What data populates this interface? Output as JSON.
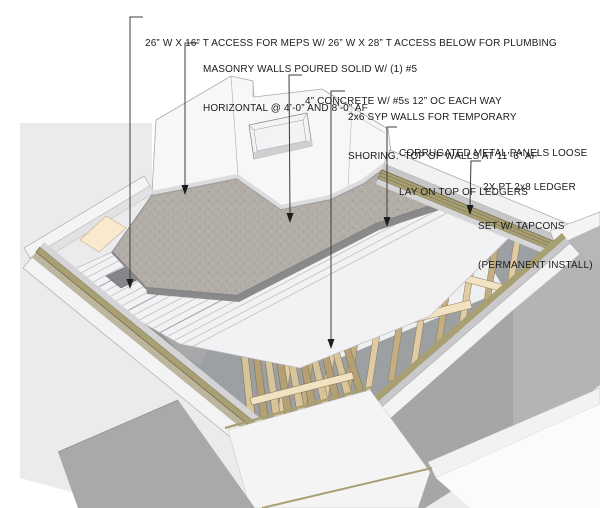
{
  "drawing": {
    "type": "construction-detail-axonometric",
    "subject": "Temporary shoring and new concrete deck over wall opening"
  },
  "annotations": [
    {
      "id": "access",
      "lines": [
        "26” W X 16” T ACCESS FOR MEPS W/ 26” W X 28” T ACCESS BELOW FOR PLUMBING"
      ]
    },
    {
      "id": "masonry",
      "lines": [
        "MASONRY WALLS POURED SOLID W/ (1) #5",
        "HORIZONTAL @ 4’-0” AND 8’-0” AF"
      ]
    },
    {
      "id": "concrete",
      "lines": [
        "4” CONCRETE W/ #5s 12” OC EACH WAY"
      ]
    },
    {
      "id": "shoring",
      "lines": [
        "2x6 SYP WALLS FOR TEMPORARY",
        "SHORING.  TOP OF WALLS AT 11’-6” AF"
      ]
    },
    {
      "id": "panels",
      "lines": [
        "CORRUGATED METAL PANELS LOOSE",
        "LAY ON TOP OF LEDGERS"
      ]
    },
    {
      "id": "ledger",
      "lines": [
        "2X PT 2x8 LEDGER",
        "SET W/ TAPCONS",
        "(PERMANENT INSTALL)"
      ]
    }
  ],
  "materials": {
    "backdrop": "#ebebed",
    "concrete_slab": "#b2ada6",
    "slab_edge": "#8a8a8d",
    "corrugated_panel": "#f2f2f4",
    "panel_ridge": "#bfbfc2",
    "stud_light": "#dfcca4",
    "stud_dark": "#c3ad82",
    "plate": "#f1e3c1",
    "ledger_olive": "#a89f72",
    "ledger_edge": "#6b6449",
    "wall_white": "#f7f7f8",
    "interior_gray": "#9da0a2",
    "outer_gray": "#a9a9ab",
    "leader": "#3c3c3c",
    "text": "#1b1b1b"
  }
}
